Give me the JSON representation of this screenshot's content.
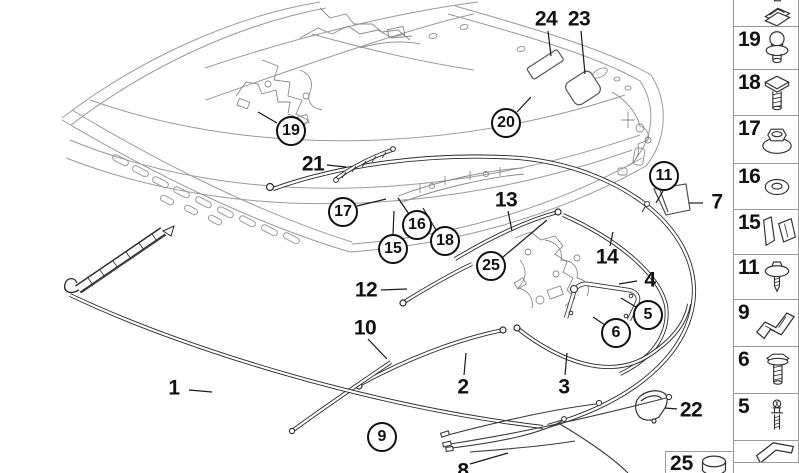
{
  "diagram": {
    "title": "convertible-top-seals-and-moldings-parts-diagram",
    "circled_callouts": [
      {
        "id": "19",
        "x": 291,
        "y": 131
      },
      {
        "id": "20",
        "x": 506,
        "y": 123
      },
      {
        "id": "17",
        "x": 343,
        "y": 212
      },
      {
        "id": "16",
        "x": 417,
        "y": 225
      },
      {
        "id": "15",
        "x": 393,
        "y": 249
      },
      {
        "id": "18",
        "x": 445,
        "y": 241
      },
      {
        "id": "25",
        "x": 491,
        "y": 266
      },
      {
        "id": "11",
        "x": 664,
        "y": 176
      },
      {
        "id": "5",
        "x": 648,
        "y": 315
      },
      {
        "id": "6",
        "x": 616,
        "y": 333
      },
      {
        "id": "9",
        "x": 382,
        "y": 437
      }
    ],
    "plain_callouts": [
      {
        "id": "24",
        "x": 546,
        "y": 19
      },
      {
        "id": "23",
        "x": 579,
        "y": 19
      },
      {
        "id": "21",
        "x": 313,
        "y": 164
      },
      {
        "id": "13",
        "x": 506,
        "y": 200
      },
      {
        "id": "14",
        "x": 607,
        "y": 257
      },
      {
        "id": "12",
        "x": 366,
        "y": 290
      },
      {
        "id": "10",
        "x": 365,
        "y": 328
      },
      {
        "id": "7",
        "x": 717,
        "y": 202
      },
      {
        "id": "4",
        "x": 650,
        "y": 280
      },
      {
        "id": "2",
        "x": 463,
        "y": 387
      },
      {
        "id": "3",
        "x": 564,
        "y": 387
      },
      {
        "id": "1",
        "x": 174,
        "y": 388
      },
      {
        "id": "22",
        "x": 691,
        "y": 410
      },
      {
        "id": "8",
        "x": 463,
        "y": 471
      }
    ]
  },
  "sidebar": {
    "items": [
      {
        "number": "",
        "icon": "retainer-clip-icon",
        "height": 28
      },
      {
        "number": "19",
        "icon": "ball-stud-icon",
        "height": 44
      },
      {
        "number": "18",
        "icon": "square-head-bolt-icon",
        "height": 47
      },
      {
        "number": "17",
        "icon": "flange-nut-icon",
        "height": 49
      },
      {
        "number": "16",
        "icon": "washer-icon",
        "height": 47
      },
      {
        "number": "15",
        "icon": "angle-clip-icon",
        "height": 46
      },
      {
        "number": "11",
        "icon": "washer-screw-icon",
        "height": 46
      },
      {
        "number": "9",
        "icon": "z-bracket-icon",
        "height": 48
      },
      {
        "number": "6",
        "icon": "hex-bolt-icon",
        "height": 48
      },
      {
        "number": "5",
        "icon": "expansion-rivet-icon",
        "height": 48
      },
      {
        "number": "",
        "icon": "z-clip-icon",
        "height": 23
      }
    ],
    "bottom_item": {
      "number": "25",
      "icon": "cap-icon"
    }
  },
  "colors": {
    "callout_ink": "#111111",
    "seal_ink": "#2a2a2a",
    "frame_line": "#9a9a9a",
    "box_border": "#999999",
    "background": "#ffffff"
  }
}
